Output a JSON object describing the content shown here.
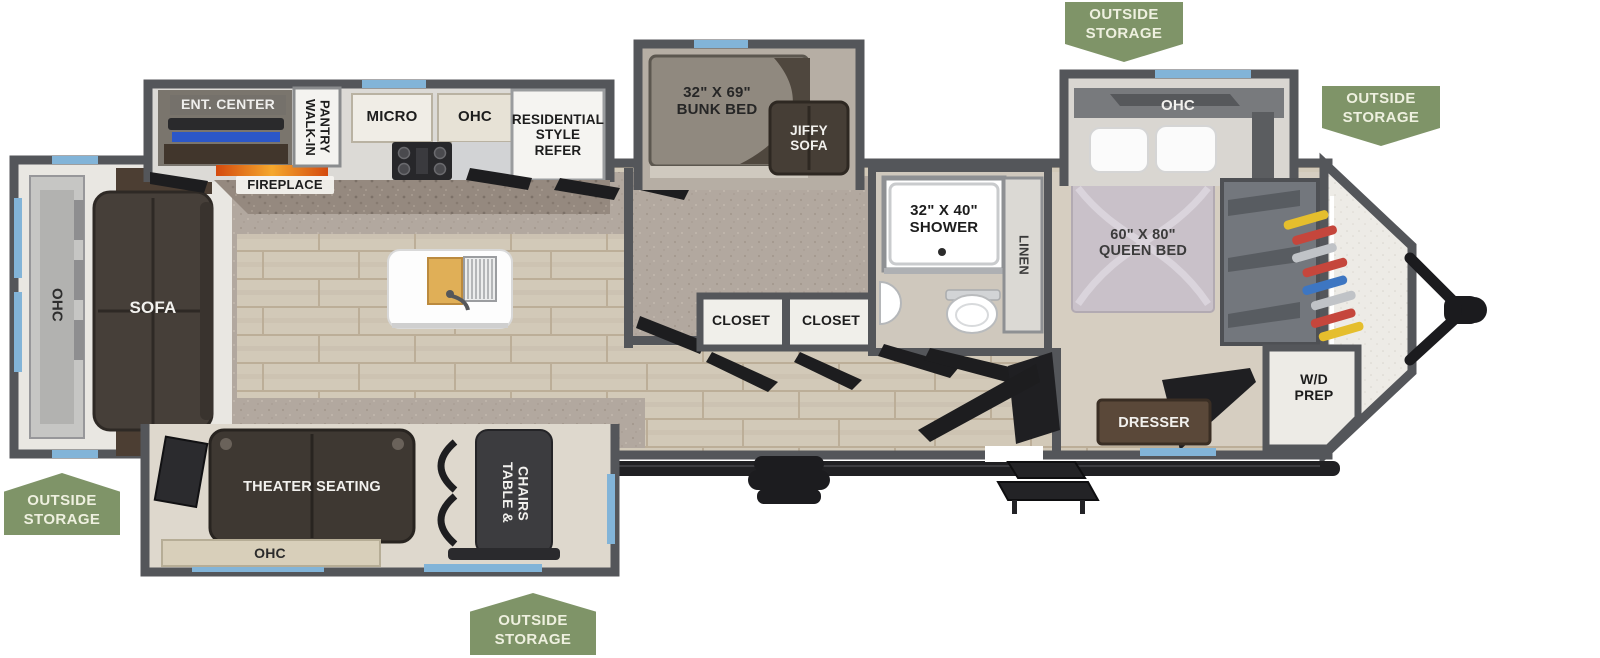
{
  "badges": {
    "top_center": "OUTSIDE\nSTORAGE",
    "top_right": "OUTSIDE\nSTORAGE",
    "bottom_left": "OUTSIDE\nSTORAGE",
    "bottom_center": "OUTSIDE\nSTORAGE"
  },
  "labels": {
    "ent_center": "ENT. CENTER",
    "walk_in_pantry": "WALK-IN\nPANTRY",
    "micro": "MICRO",
    "ohc_kitchen": "OHC",
    "refer": "RESIDENTIAL\nSTYLE\nREFER",
    "fireplace": "FIREPLACE",
    "bunk_bed": "32\" X 69\"\nBUNK BED",
    "jiffy_sofa": "JIFFY\nSOFA",
    "shower": "32\" X 40\"\nSHOWER",
    "linen": "LINEN",
    "ohc_bedroom": "OHC",
    "queen_bed": "60\" X 80\"\nQUEEN BED",
    "ohc_rear": "OHC",
    "sofa": "SOFA",
    "closet_left": "CLOSET",
    "closet_right": "CLOSET",
    "theater_seating": "THEATER SEATING",
    "table_chairs": "TABLE &\nCHAIRS",
    "ohc_bottom": "OHC",
    "dresser": "DRESSER",
    "wd_prep": "W/D\nPREP"
  },
  "colors": {
    "badge-green": "#7f9468",
    "wall-gray": "#54565a",
    "window-blue": "#82b4d8",
    "floor-wood": "#d2c9b8",
    "carpet-gray": "#b2a89f",
    "sofa-brown": "#463f39",
    "bed-mauve": "#c9c1c9",
    "flame-orange": "#f5a82d"
  }
}
